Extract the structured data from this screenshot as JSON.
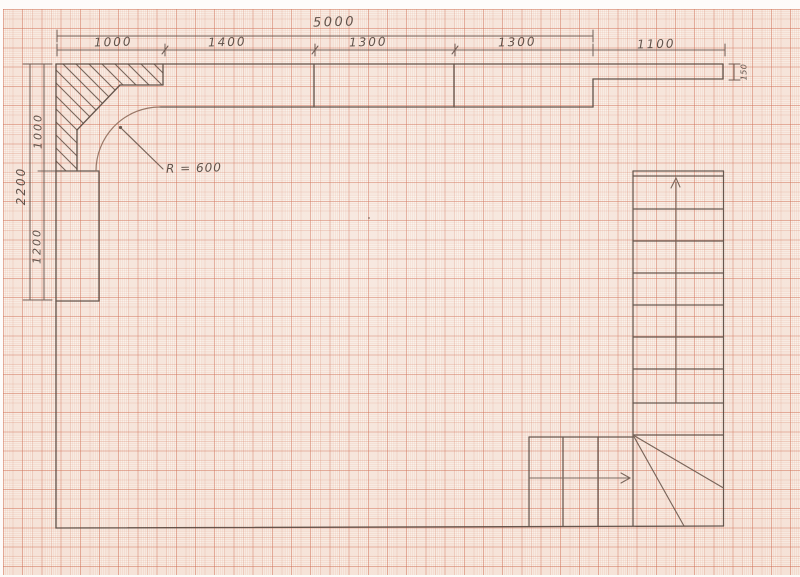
{
  "dims": {
    "top_total": "5000",
    "top_segments": [
      "1000",
      "1400",
      "1300",
      "1300",
      "1100"
    ],
    "left_total": "2200",
    "left_segments": [
      "1000",
      "1200"
    ],
    "right_thickness": "150",
    "radius_note": "R = 600"
  },
  "colors": {
    "paper": "#faf2ea",
    "grid_line": "#c6563a",
    "pencil": "#5a4a41",
    "pencil_light": "#6d594e"
  }
}
